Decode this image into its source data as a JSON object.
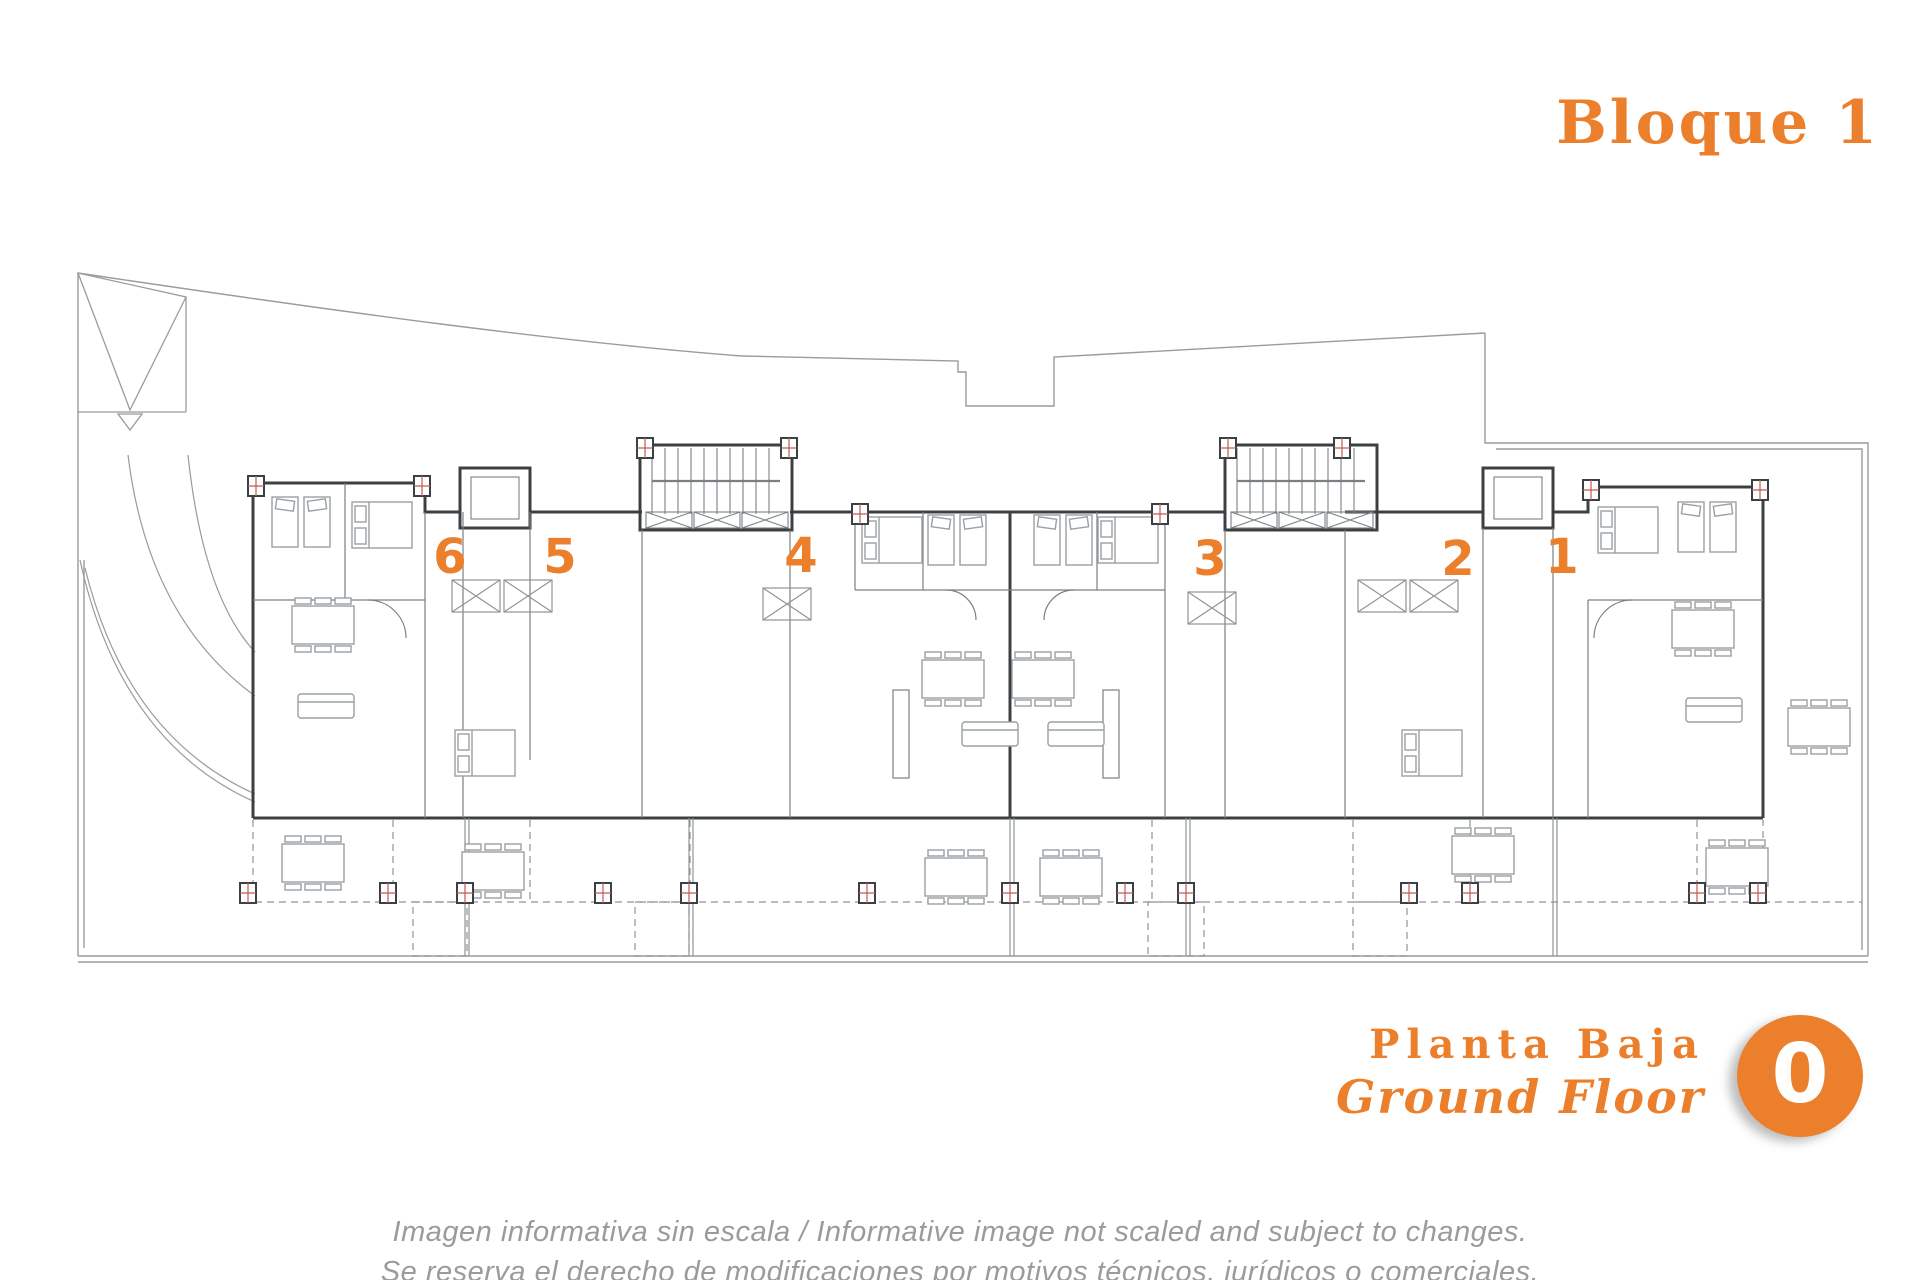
{
  "header": {
    "block_title": "Bloque 1"
  },
  "plan": {
    "type": "floor-plan",
    "unit_numbers": [
      "6",
      "5",
      "4",
      "3",
      "2",
      "1"
    ]
  },
  "legend": {
    "floor_label_es": "Planta Baja",
    "floor_label_en": "Ground Floor",
    "floor_badge": "0"
  },
  "disclaimer": {
    "line1": "Imagen informativa sin escala /  Informative image not scaled and subject to changes.",
    "line2": "Se reserva el derecho de modificaciones por motivos técnicos, jurídicos o comerciales."
  },
  "colors": {
    "accent_orange": "#EC7F2C",
    "disclaimer_gray": "#9B9B9B",
    "wall_dark": "#3D4043",
    "line_gray": "#8F9496",
    "marker_red": "#C05A55"
  }
}
